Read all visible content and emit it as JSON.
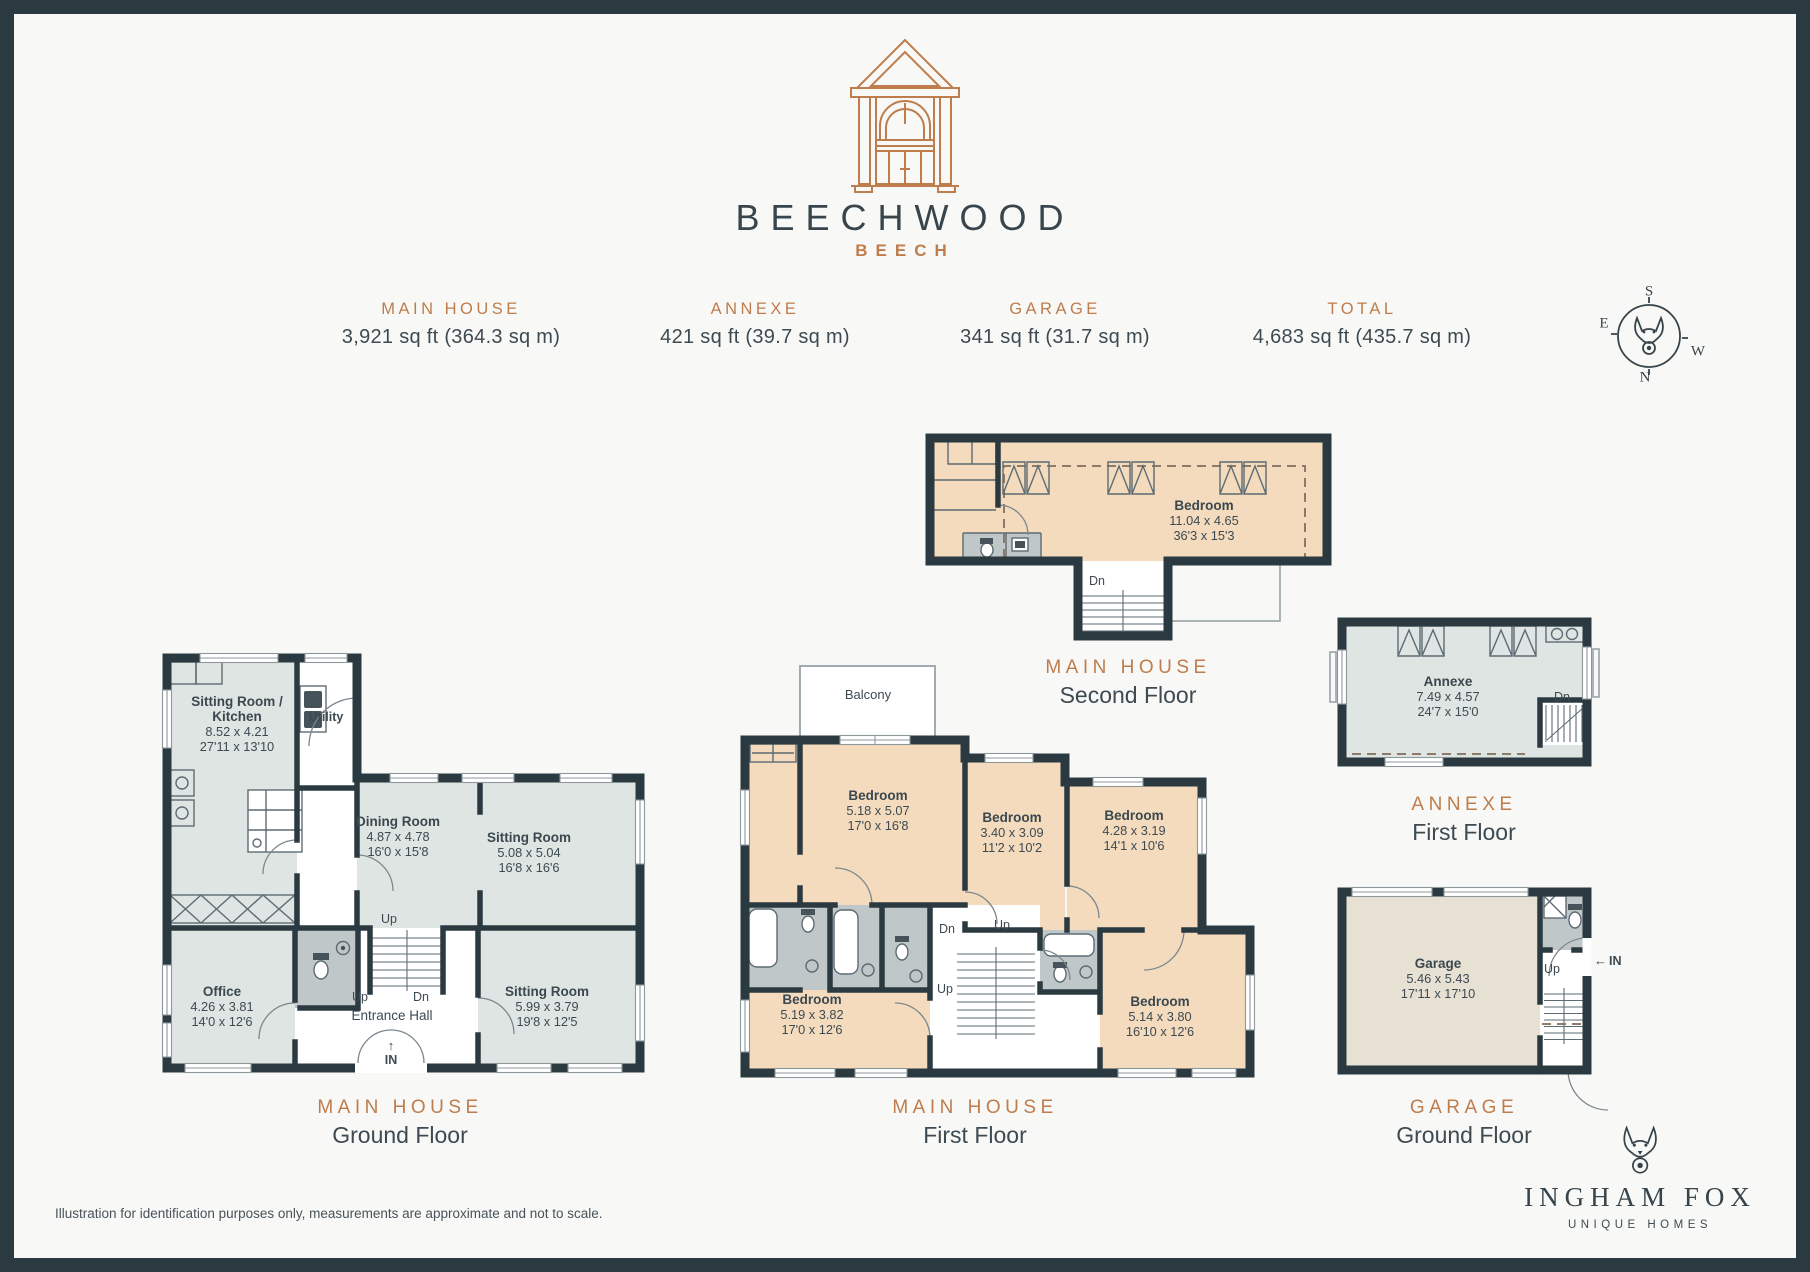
{
  "header": {
    "title": "BEECHWOOD",
    "subtitle": "BEECH",
    "logo": "porch-icon"
  },
  "stats": [
    {
      "label": "MAIN HOUSE",
      "value": "3,921 sq ft (364.3 sq m)"
    },
    {
      "label": "ANNEXE",
      "value": "421 sq ft (39.7 sq m)"
    },
    {
      "label": "GARAGE",
      "value": "341 sq ft (31.7 sq m)"
    },
    {
      "label": "TOTAL",
      "value": "4,683 sq ft (435.7 sq m)"
    }
  ],
  "compass": {
    "top": "S",
    "left": "E",
    "right": "W",
    "bottom": "N",
    "icon": "fox-icon"
  },
  "plans": {
    "second_floor": {
      "caption_title": "MAIN HOUSE",
      "caption_sub": "Second Floor",
      "bedroom": {
        "name": "Bedroom",
        "metric": "11.04 x 4.65",
        "imperial": "36'3 x 15'3"
      },
      "labels": {
        "dn": "Dn"
      }
    },
    "ground_floor": {
      "caption_title": "MAIN HOUSE",
      "caption_sub": "Ground Floor",
      "sitting_kitchen": {
        "name": "Sitting Room /",
        "name2": "Kitchen",
        "metric": "8.52 x 4.21",
        "imperial": "27'11 x 13'10"
      },
      "utility": {
        "name": "Utility"
      },
      "dining": {
        "name": "Dining Room",
        "metric": "4.87 x 4.78",
        "imperial": "16'0 x 15'8"
      },
      "sitting": {
        "name": "Sitting Room",
        "metric": "5.08 x 5.04",
        "imperial": "16'8 x 16'6"
      },
      "office": {
        "name": "Office",
        "metric": "4.26 x 3.81",
        "imperial": "14'0 x 12'6"
      },
      "entrance": {
        "name": "Entrance Hall"
      },
      "sitting2": {
        "name": "Sitting Room",
        "metric": "5.99 x 3.79",
        "imperial": "19'8 x 12'5"
      },
      "labels": {
        "up": "Up",
        "dn": "Dn",
        "in": "IN",
        "in_arrow": "↑"
      }
    },
    "first_floor": {
      "caption_title": "MAIN HOUSE",
      "caption_sub": "First Floor",
      "balcony": "Balcony",
      "bedroom1": {
        "name": "Bedroom",
        "metric": "5.18 x 5.07",
        "imperial": "17'0 x 16'8"
      },
      "bedroom2": {
        "name": "Bedroom",
        "metric": "3.40 x 3.09",
        "imperial": "11'2 x 10'2"
      },
      "bedroom3": {
        "name": "Bedroom",
        "metric": "4.28 x 3.19",
        "imperial": "14'1 x 10'6"
      },
      "bedroom4": {
        "name": "Bedroom",
        "metric": "5.19 x 3.82",
        "imperial": "17'0 x 12'6"
      },
      "bedroom5": {
        "name": "Bedroom",
        "metric": "5.14 x 3.80",
        "imperial": "16'10 x 12'6"
      },
      "labels": {
        "up": "Up",
        "dn": "Dn"
      }
    },
    "annexe": {
      "caption_title": "ANNEXE",
      "caption_sub": "First Floor",
      "room": {
        "name": "Annexe",
        "metric": "7.49 x 4.57",
        "imperial": "24'7 x 15'0"
      },
      "labels": {
        "dn": "Dn"
      }
    },
    "garage": {
      "caption_title": "GARAGE",
      "caption_sub": "Ground Floor",
      "room": {
        "name": "Garage",
        "metric": "5.46 x 5.43",
        "imperial": "17'11 x 17'10"
      },
      "labels": {
        "up": "Up",
        "in": "IN",
        "in_arrow": "←"
      }
    }
  },
  "footer": {
    "disclaimer": "Illustration for identification purposes only, measurements are approximate and not to scale."
  },
  "brand": {
    "name": "INGHAM FOX",
    "tagline": "UNIQUE HOMES",
    "icon": "fox-icon"
  },
  "colors": {
    "accent": "#bf7c4c",
    "wall": "#2b3940",
    "bedroom_fill": "#f4dbbd",
    "living_fill": "#dfe5e2",
    "bath_fill": "#c0c7c9",
    "garage_fill": "#e7e1d4",
    "text": "#3d4a52",
    "background": "#f8f9f6"
  }
}
